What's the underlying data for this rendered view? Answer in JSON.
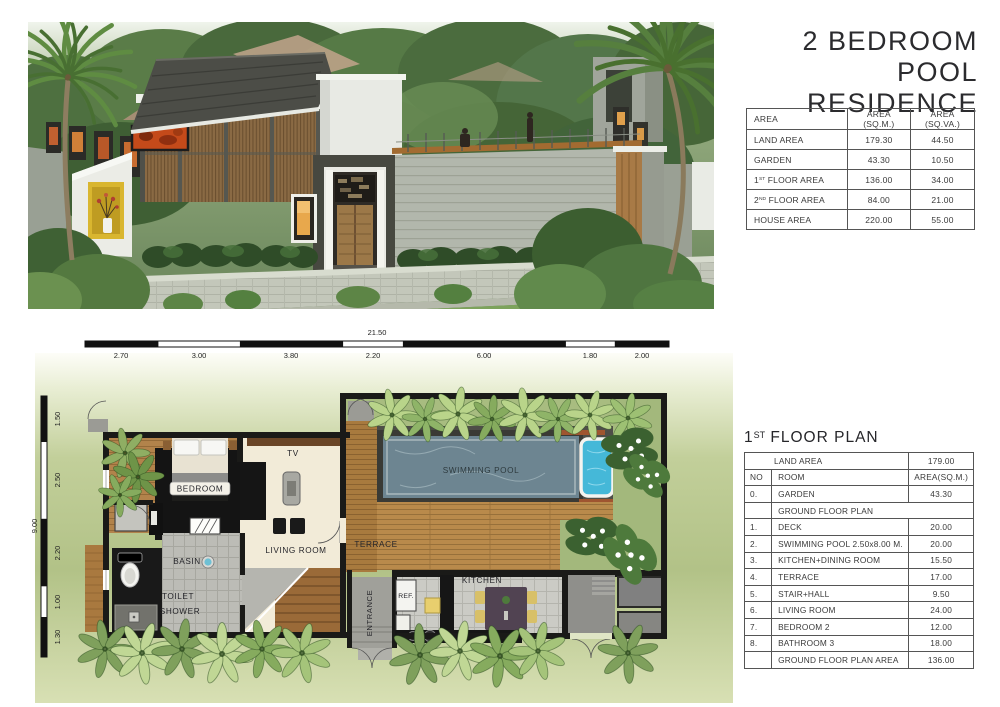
{
  "header": {
    "title_line1": "2 BEDROOM",
    "title_line2": "POOL RESIDENCE"
  },
  "area_table": {
    "headers": [
      "AREA",
      "AREA (SQ.M.)",
      "AREA (SQ.VA.)"
    ],
    "rows": [
      {
        "label": "LAND AREA",
        "sqm": "179.30",
        "sqva": "44.50"
      },
      {
        "label": "GARDEN",
        "sqm": "43.30",
        "sqva": "10.50"
      },
      {
        "label": [
          "1",
          "ST",
          " FLOOR AREA"
        ],
        "sqm": "136.00",
        "sqva": "34.00"
      },
      {
        "label": [
          "2",
          "ND",
          " FLOOR AREA"
        ],
        "sqm": "84.00",
        "sqva": "21.00"
      },
      {
        "label": "HOUSE AREA",
        "sqm": "220.00",
        "sqva": "55.00"
      }
    ]
  },
  "floor_plan": {
    "title": {
      "num": "1",
      "sup": "ST",
      "rest": " FLOOR PLAN"
    },
    "rows": [
      {
        "kind": "land",
        "label": "LAND AREA",
        "value": "179.00"
      },
      {
        "kind": "header",
        "no": "NO",
        "label": "ROOM",
        "value": "AREA(SQ.M.)"
      },
      {
        "kind": "item",
        "no": "0.",
        "label": "GARDEN",
        "value": "43.30"
      },
      {
        "kind": "section",
        "label": "GROUND FLOOR PLAN"
      },
      {
        "kind": "item",
        "no": "1.",
        "label": "DECK",
        "value": "20.00"
      },
      {
        "kind": "item",
        "no": "2.",
        "label": "SWIMMING POOL 2.50x8.00 M.",
        "value": "20.00"
      },
      {
        "kind": "item",
        "no": "3.",
        "label": "KITCHEN+DINING ROOM",
        "value": "15.50"
      },
      {
        "kind": "item",
        "no": "4.",
        "label": "TERRACE",
        "value": "17.00"
      },
      {
        "kind": "item",
        "no": "5.",
        "label": "STAIR+HALL",
        "value": "9.50"
      },
      {
        "kind": "item",
        "no": "6.",
        "label": "LIVING ROOM",
        "value": "24.00"
      },
      {
        "kind": "item",
        "no": "7.",
        "label": "BEDROOM 2",
        "value": "12.00"
      },
      {
        "kind": "item",
        "no": "8.",
        "label": "BATHROOM 3",
        "value": "18.00"
      },
      {
        "kind": "total",
        "no": "",
        "label": "GROUND FLOOR PLAN AREA",
        "value": "136.00"
      }
    ]
  },
  "plan": {
    "dim_top_total": "21.50",
    "dims_top": [
      "2.70",
      "3.00",
      "3.80",
      "2.20",
      "6.00",
      "1.80",
      "2.00"
    ],
    "dim_left_total": "9.00",
    "dims_left": [
      "1.50",
      "2.50",
      "2.20",
      "1.00",
      "1.30"
    ],
    "labels": {
      "bedroom": "BEDROOM",
      "tv": "TV",
      "living": "LIVING ROOM",
      "terrace": "TERRACE",
      "pool": "SWIMMING POOL",
      "kitchen": "KITCHEN",
      "ref": "REF.",
      "entrance": "ENTRANCE",
      "basin": "BASIN",
      "toilet": "TOILET",
      "shower": "SHOWER"
    }
  },
  "colors": {
    "lawn_green": "#b2c287",
    "pool_water": "#6d8591",
    "jacuzzi_blue": "#45b8d8",
    "deck_wood": "#b98a4b",
    "art_panel_orange": "#c44a1a",
    "niche_yellow": "#d9b62f",
    "roof_gray": "#4c4d47",
    "louver_wood": "#8a6a44"
  }
}
